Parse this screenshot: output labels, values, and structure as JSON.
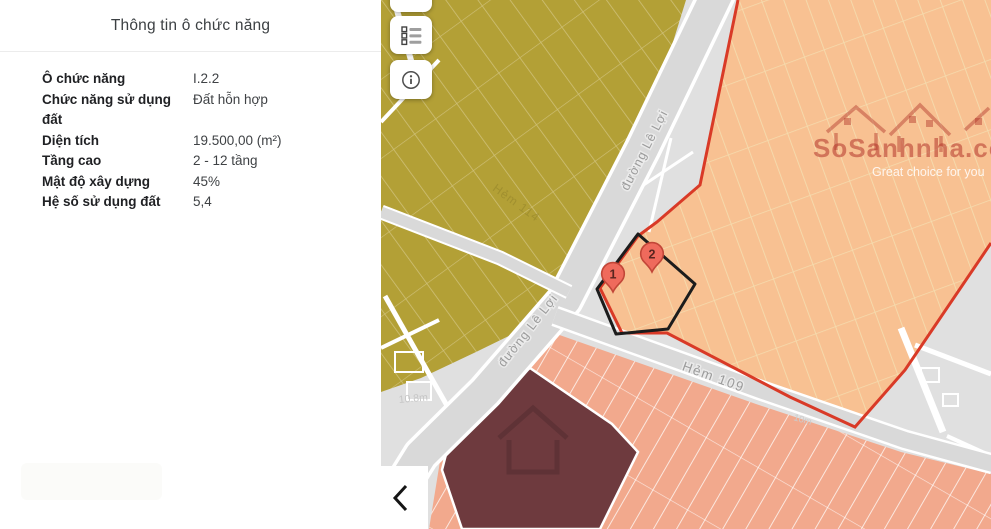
{
  "panel": {
    "title": "Thông tin ô chức năng",
    "rows": [
      {
        "label": "Ô chức năng",
        "value": "I.2.2"
      },
      {
        "label": "Chức năng sử dụng đất",
        "value": "Đất hỗn hợp"
      },
      {
        "label": "Diện tích",
        "value": "19.500,00 (m²)"
      },
      {
        "label": "Tầng cao",
        "value": "2 - 12 tầng"
      },
      {
        "label": "Mật độ xây dựng",
        "value": "45%"
      },
      {
        "label": "Hệ số sử dụng đất",
        "value": "5,4"
      }
    ]
  },
  "map": {
    "labels": {
      "street_main_upper": "đường Lê Lợi",
      "street_main_lower": "đường Lê Lợi",
      "alley_109": "Hẻm 109",
      "alley_114": "Hẻm 114",
      "dim_108": "10.8m",
      "dim_10": "10m"
    },
    "markers": [
      {
        "number": "1"
      },
      {
        "number": "2"
      }
    ],
    "watermark": {
      "brand": "SoSanhnha.com",
      "tagline": "Great choice for you"
    },
    "icons": {
      "legend": "legend-list-icon",
      "info": "info-icon",
      "collapse": "chevron-left-icon"
    },
    "colors": {
      "base": "#e0e0e0",
      "road": "#d9d9d9",
      "olive": "#b3a036",
      "olive-line": "#cfc078",
      "orange": "#f8c192",
      "orange-line": "#f5dcae",
      "peach": "#f2a98d",
      "maroon": "#6e3a3e",
      "accent-red": "#d93a27",
      "marker": "#ef6a5c",
      "marker-border": "#c24638",
      "watermark-red": "#b2352a"
    }
  }
}
